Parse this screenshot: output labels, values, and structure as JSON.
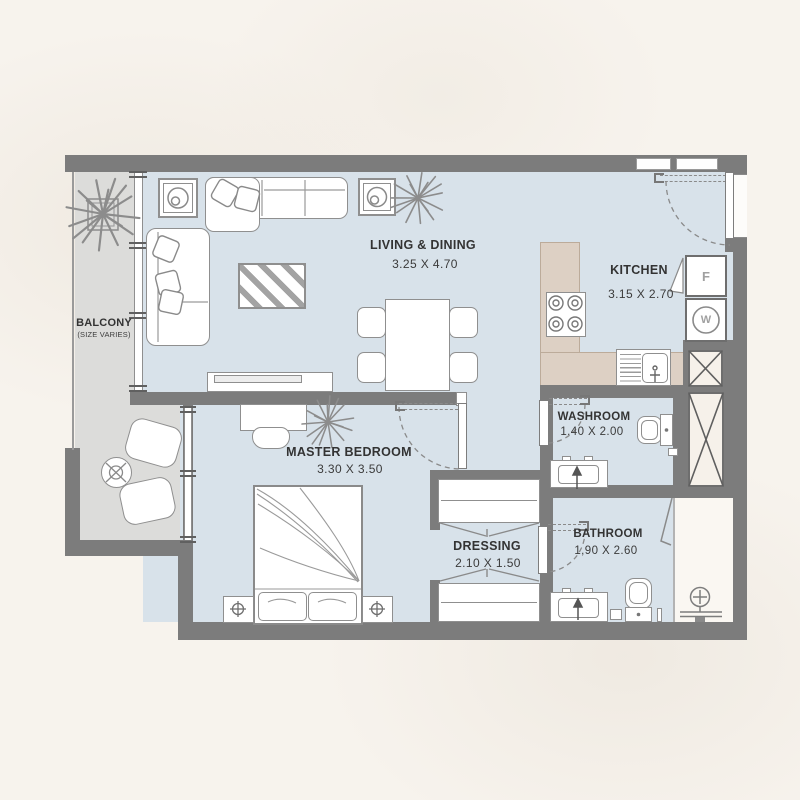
{
  "colors": {
    "background": "#f7f3ed",
    "wall": "#7c7c7c",
    "interior_floor": "#d8e2ea",
    "balcony_floor": "#dcdcda",
    "kitchen_counter": "#ddd0c4",
    "line": "#8a8a8a"
  },
  "rooms": {
    "balcony": {
      "name": "BALCONY",
      "note": "(SIZE VARIES)"
    },
    "living": {
      "name": "LIVING & DINING",
      "dims": "3.25 X 4.70"
    },
    "kitchen": {
      "name": "KITCHEN",
      "dims": "3.15 X 2.70"
    },
    "master_bedroom": {
      "name": "MASTER BEDROOM",
      "dims": "3.30 X 3.50"
    },
    "washroom": {
      "name": "WASHROOM",
      "dims": "1.40 X 2.00"
    },
    "dressing": {
      "name": "DRESSING",
      "dims": "2.10 X 1.50"
    },
    "bathroom": {
      "name": "BATHROOM",
      "dims": "1,90 X 2.60"
    }
  },
  "appliances": {
    "fridge": "F",
    "washing_machine": "W"
  }
}
